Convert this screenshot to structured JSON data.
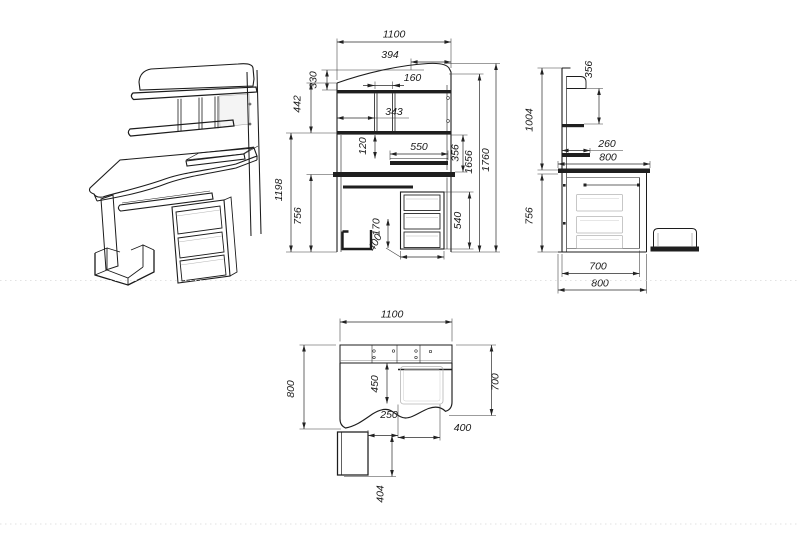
{
  "views": {
    "front": {
      "dims": {
        "overall_width": "1100",
        "upper_right_width": "394",
        "niche_width": "160",
        "compartment_width": "343",
        "top_curve_height": "330",
        "hutch_section_height": "442",
        "upper_structure_height": "1198",
        "desk_height": "756",
        "shelf_drop": "120",
        "keyboard_shelf_width": "550",
        "shelf_above_desktop": "356",
        "body_height": "1656",
        "overall_height": "1760",
        "drawer_block_height": "540",
        "stand_height": "170",
        "drawer_block_width": "400"
      }
    },
    "side": {
      "dims": {
        "hutch_height": "1004",
        "top_to_shelf": "356",
        "shelf_depth": "260",
        "desktop_depth": "800",
        "desk_height": "756",
        "cabinet_depth": "700",
        "overall_depth": "800"
      }
    },
    "plan": {
      "dims": {
        "overall_width": "1100",
        "left_depth": "800",
        "right_depth": "700",
        "recess_depth": "450",
        "stand_clearance": "250",
        "tray_width": "400",
        "stand_protrusion": "404"
      }
    }
  }
}
